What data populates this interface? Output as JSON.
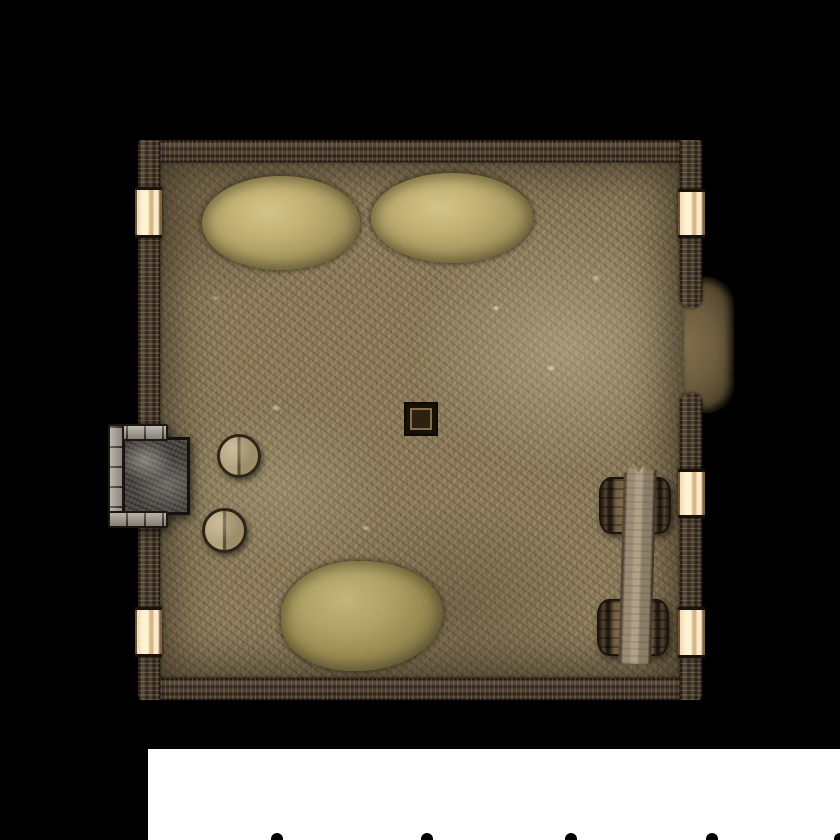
{
  "scene": {
    "type": "top-down dungeon room battlemap tile",
    "background_color": "#000000",
    "page_color": "#ffffff"
  },
  "room": {
    "label": "dirt-floor-room",
    "floor_color": "#8c7c5b",
    "wall_color": "#3c3126",
    "window_color": "#ecd3a6",
    "windows": [
      {
        "id": "window-left-top"
      },
      {
        "id": "window-left-bottom"
      },
      {
        "id": "window-right-top"
      },
      {
        "id": "window-right-middle"
      },
      {
        "id": "window-right-bottom"
      }
    ],
    "doorway": {
      "id": "right-wall-opening",
      "floor_color": "#6d5e3f"
    }
  },
  "objects": [
    {
      "id": "hay-pile-top-left",
      "color": "#b5a76b"
    },
    {
      "id": "hay-pile-top-right",
      "color": "#b5a76b"
    },
    {
      "id": "hay-pile-bottom",
      "color": "#a3955f"
    },
    {
      "id": "stool-upper",
      "color": "#a89877"
    },
    {
      "id": "stool-lower",
      "color": "#a89877"
    },
    {
      "id": "fireplace",
      "stone_color": "#a59e91",
      "hearth_color": "#4c4843"
    },
    {
      "id": "floor-hatch",
      "color": "#2c2212"
    },
    {
      "id": "barrel-upper",
      "color": "#86704e"
    },
    {
      "id": "barrel-lower",
      "color": "#86704e"
    },
    {
      "id": "wooden-plank",
      "color": "#9b8c75"
    }
  ],
  "page_strip": {
    "glyph_bump_count": 5
  }
}
